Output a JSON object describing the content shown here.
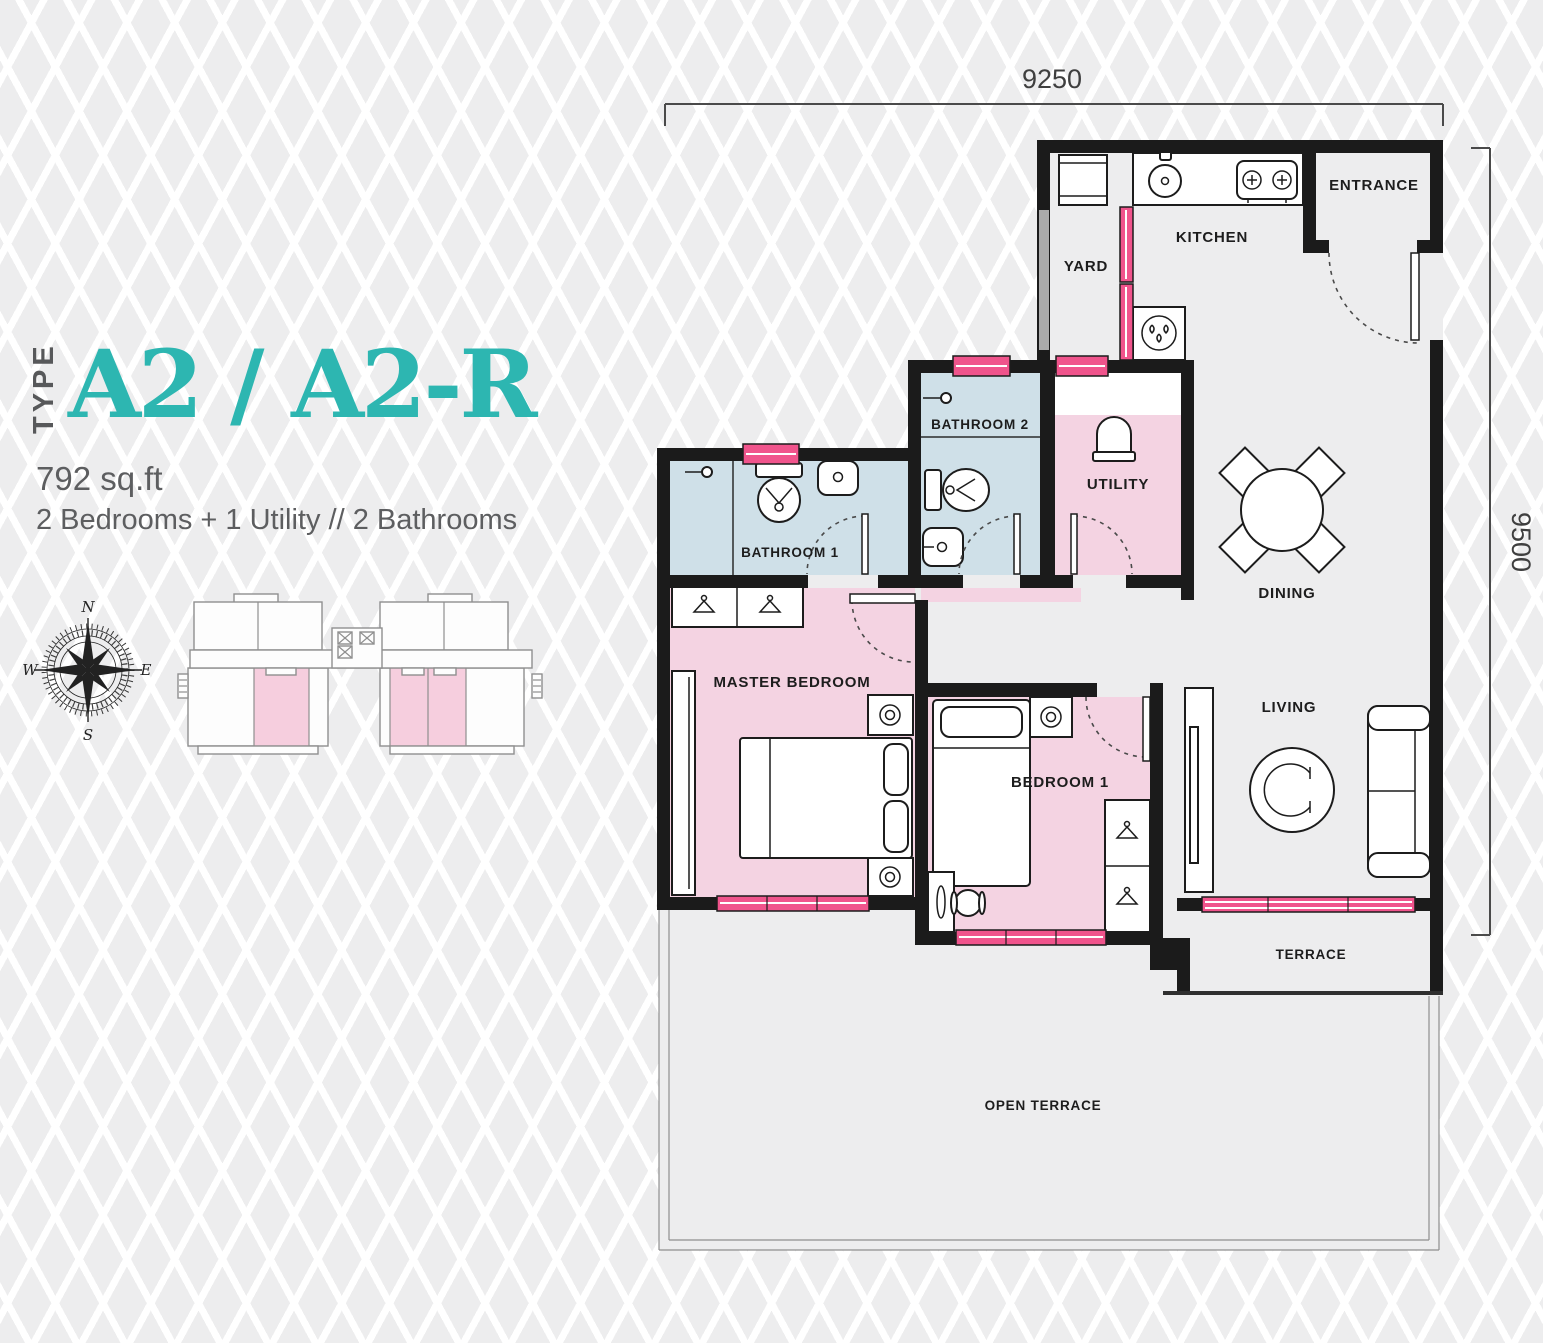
{
  "header": {
    "type_label": "TYPE",
    "title": "A2 / A2-R",
    "area": "792 sq.ft",
    "description": "2 Bedrooms + 1 Utility // 2 Bathrooms"
  },
  "dimensions": {
    "width": "9250",
    "height": "9500"
  },
  "compass": {
    "north": "N",
    "east": "E",
    "south": "S",
    "west": "W"
  },
  "rooms": {
    "entrance": {
      "label": "ENTRANCE"
    },
    "kitchen": {
      "label": "KITCHEN"
    },
    "yard": {
      "label": "YARD"
    },
    "bathroom2": {
      "label": "BATHROOM 2"
    },
    "utility": {
      "label": "UTILITY"
    },
    "dining": {
      "label": "DINING"
    },
    "bathroom1": {
      "label": "BATHROOM 1"
    },
    "master_bedroom": {
      "label": "MASTER BEDROOM"
    },
    "bedroom1": {
      "label": "BEDROOM 1"
    },
    "living": {
      "label": "LIVING"
    },
    "terrace": {
      "label": "TERRACE"
    },
    "open_terrace": {
      "label": "OPEN TERRACE"
    }
  },
  "colors": {
    "accent_teal": "#2db6b1",
    "wall_black": "#1b1b1b",
    "room_pink": "#f4d3e2",
    "room_blue": "#cfe0e8",
    "window_pink": "#f0548c",
    "background": "#ededee",
    "keyplan_pink": "#f6cede",
    "text_gray": "#5d5e60"
  }
}
